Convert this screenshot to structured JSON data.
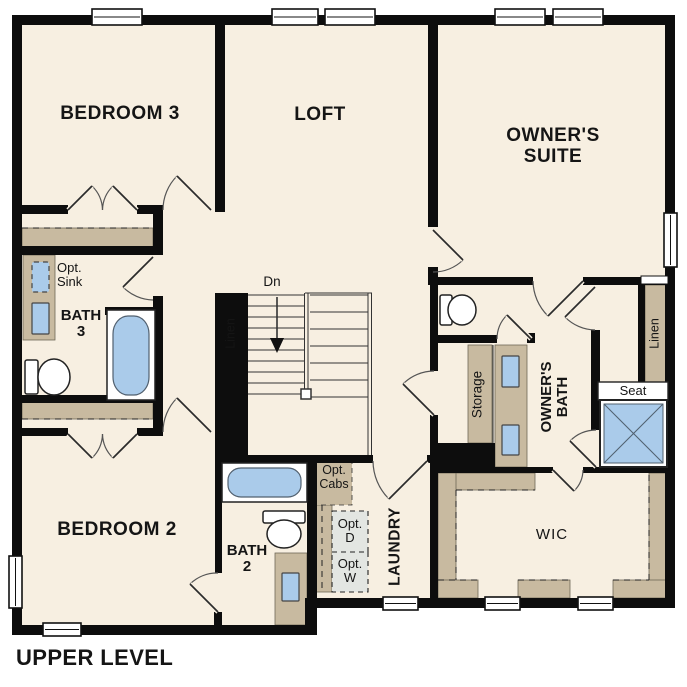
{
  "plan_title": "UPPER LEVEL",
  "rooms": {
    "bedroom3": "BEDROOM 3",
    "loft": "LOFT",
    "owners_suite": [
      "OWNER'S",
      "SUITE"
    ],
    "bedroom2": "BEDROOM 2",
    "bath3": [
      "BATH",
      "3"
    ],
    "bath2": [
      "BATH",
      "2"
    ],
    "laundry": "LAUNDRY",
    "owners_bath": [
      "OWNER'S",
      "BATH"
    ],
    "wic": "WIC"
  },
  "closets": {
    "linen_left": "Linen",
    "linen_right": "Linen",
    "storage": "Storage"
  },
  "features": {
    "seat": "Seat",
    "stairs_down": "Dn"
  },
  "optional_items": {
    "opt_sink": [
      "Opt.",
      "Sink"
    ],
    "opt_cabs": [
      "Opt.",
      "Cabs"
    ],
    "opt_dryer": [
      "Opt.",
      "D"
    ],
    "opt_washer": [
      "Opt.",
      "W"
    ]
  },
  "colors": {
    "floor": "#f7efe1",
    "wall": "#0d0d0d",
    "cabinetry_tan": "#c8baa0",
    "fixture_blue": "#aacbea",
    "optional_gray": "#e3e6e2"
  }
}
